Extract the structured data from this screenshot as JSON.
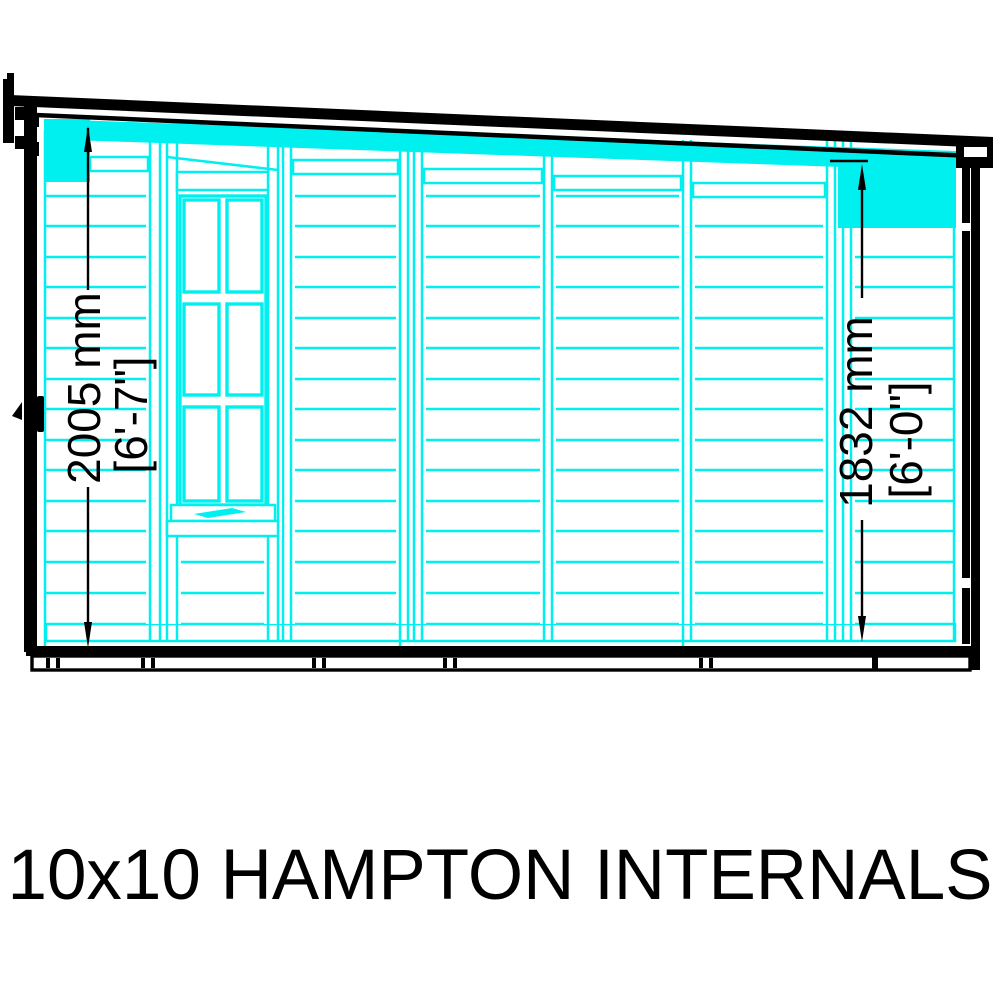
{
  "title": {
    "text": "10x10 HAMPTON INTERNALS"
  },
  "diagram": {
    "label": "shed-side-elevation-internals",
    "dimensions": {
      "left": {
        "metric": "2005 mm",
        "imperial": "[6'-7\"]"
      },
      "right": {
        "metric": "1832 mm",
        "imperial": "[6'-0\"]"
      }
    },
    "colors": {
      "cladding": "#00f0f0",
      "outline": "#000000",
      "background": "#ffffff",
      "dimension_text": "#000000"
    }
  }
}
